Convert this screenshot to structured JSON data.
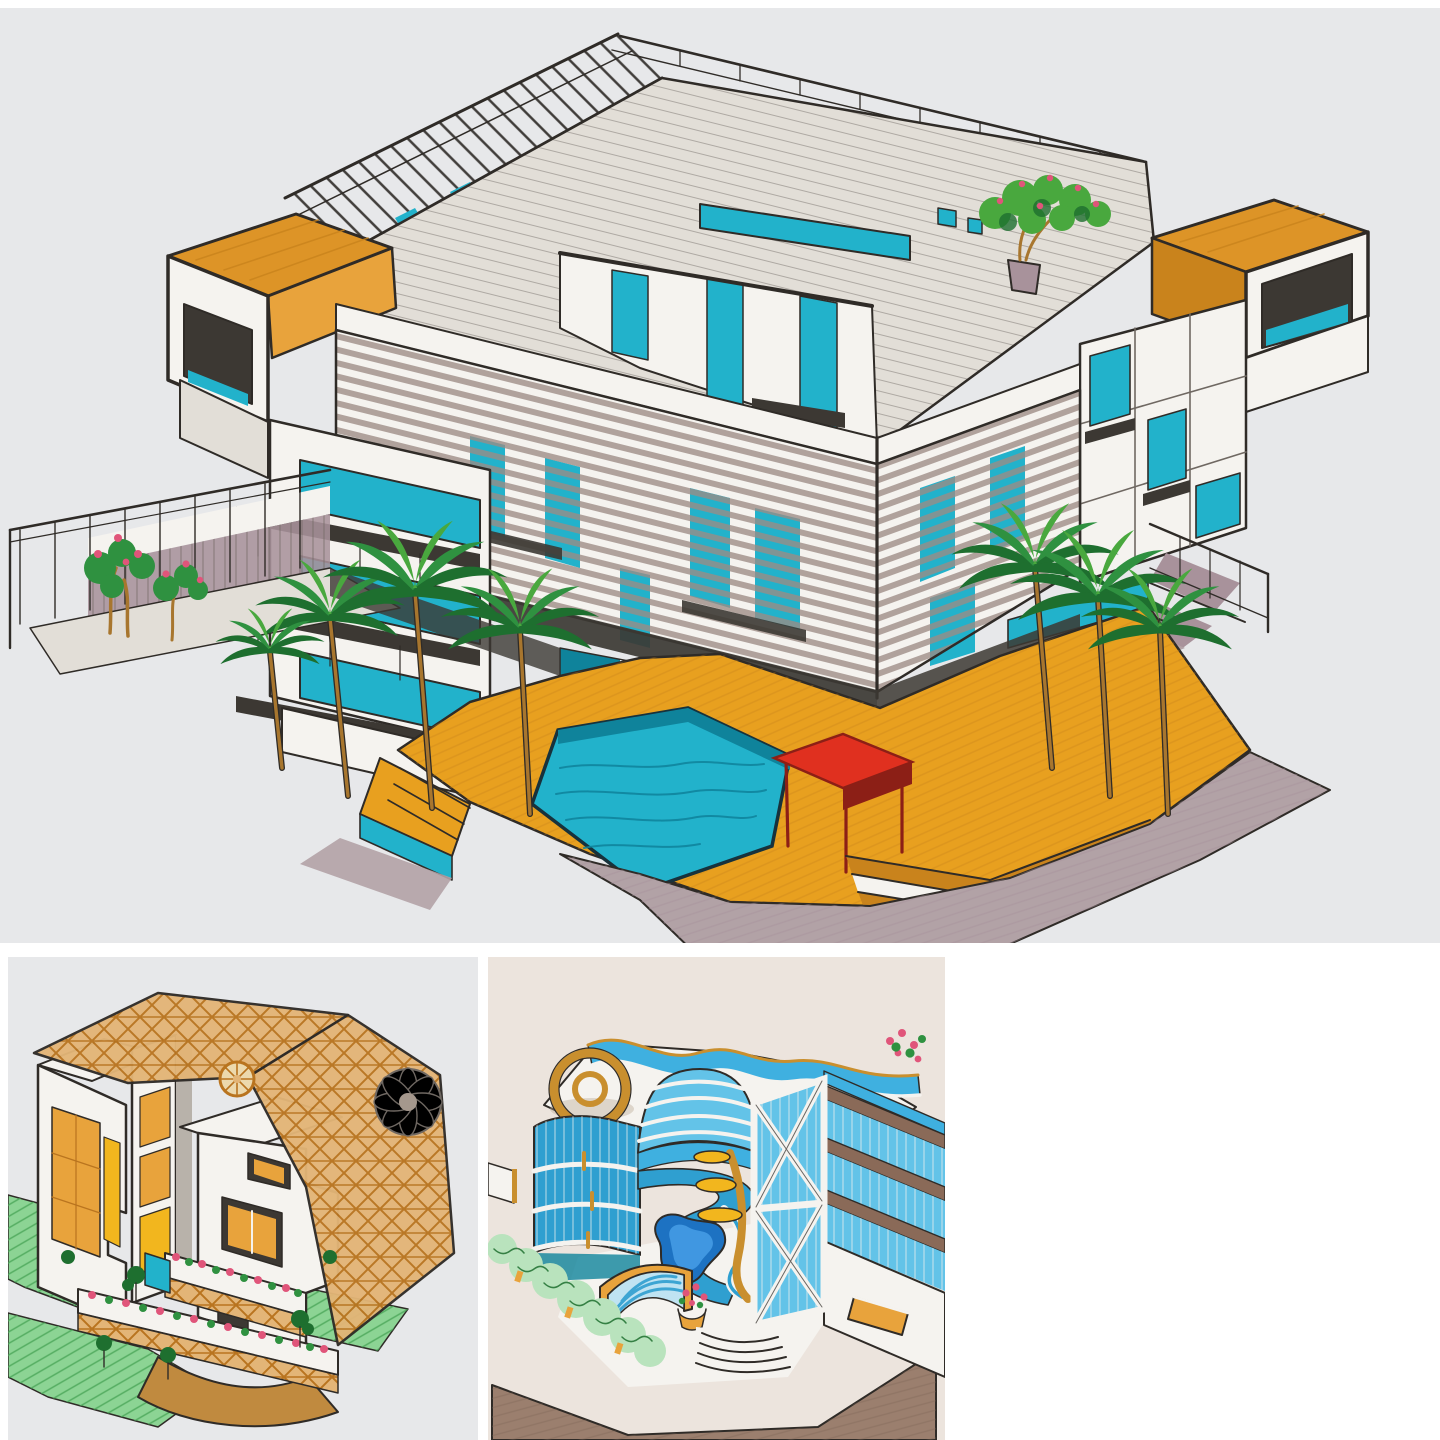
{
  "collage": {
    "panels": [
      {
        "id": "main",
        "label": "Marker sketch: modern apartment building with rooftop pergola, hexagonal pool, wooden deck, red cabana and palm trees"
      },
      {
        "id": "lattice-villa",
        "label": "Marker sketch: villa wrapped in an orange diagrid lattice shell with rosette ornament and flower balconies"
      },
      {
        "id": "curved-building",
        "label": "Marker sketch: curved blue glass building with wavy roof parapet, kidney pool and X-braced facade"
      }
    ]
  },
  "colors": {
    "paper_gray": "#e7e8ea",
    "paper_warm": "#ece4dd",
    "ink": "#2f2b27",
    "gray_line": "#6f6862",
    "slab": "#e2ded7",
    "white_paint": "#f5f3ef",
    "teal": "#22b2cb",
    "teal_dark": "#0f839b",
    "glass_blue": "#63c3e8",
    "sky_blue": "#3fb0e0",
    "blue_mid": "#2f9fd0",
    "blue_deep": "#1d72c2",
    "orange": "#dd9427",
    "orange_dark": "#c9831c",
    "amber": "#e8a33c",
    "deck": "#e8a01f",
    "yellow": "#f2b61e",
    "red": "#e0301f",
    "red_dark": "#8c1f16",
    "green": "#2f9140",
    "green_dark": "#1e6f2f",
    "green_mid": "#49a83e",
    "green_light": "#b9e3bd",
    "lawn": "#8cd494",
    "lawn_line": "#47a455",
    "mauve": "#a8929b",
    "pavement": "#b2a2a6",
    "pavement_brown": "#9b7f6e",
    "walk_brown": "#c08a3f",
    "lattice_tan": "#e3b577",
    "lattice_line": "#b9741f",
    "gold": "#c98f2e",
    "pink": "#e0557a",
    "trunk": "#a8762e",
    "shadow": "#3c3833",
    "louver_mauve": "#9c8b85"
  }
}
